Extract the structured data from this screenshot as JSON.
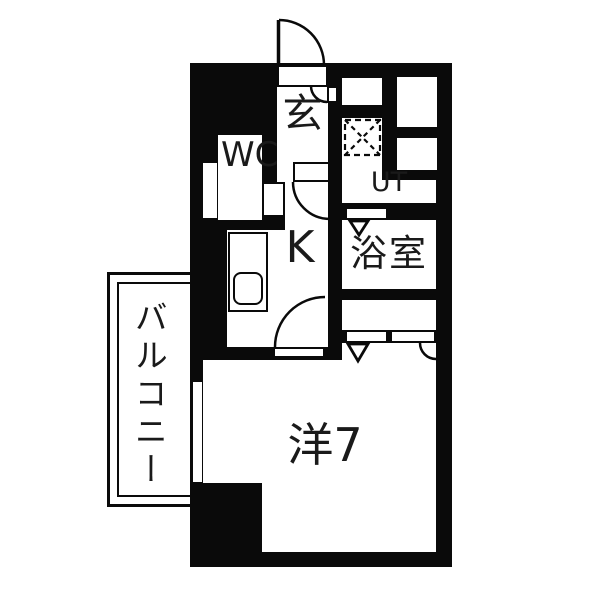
{
  "plan": {
    "type": "apartment-floor-plan",
    "rooms": {
      "genkan": {
        "label": "玄"
      },
      "wc": {
        "label": "WC"
      },
      "kitchen": {
        "label": "K"
      },
      "utility": {
        "label": "UT"
      },
      "bathroom": {
        "label": "浴室"
      },
      "main_room": {
        "label": "洋7"
      },
      "balcony": {
        "label": "バルコニー"
      }
    },
    "colors": {
      "wall": "#0a0a0a",
      "floor": "#ffffff"
    }
  }
}
